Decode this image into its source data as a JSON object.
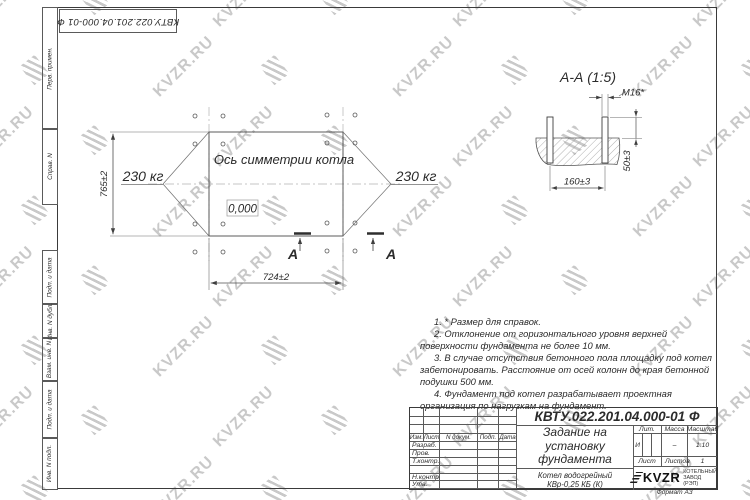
{
  "colors": {
    "line": "#3a3a3a",
    "thin": "#5a5a5a",
    "ink": "#2b2b2b",
    "wm": "#c9c9c9"
  },
  "watermark": {
    "text": "KVZR.RU"
  },
  "document": {
    "number": "КВТУ.022.201.04.000-01 Ф",
    "format_label": "Формат А3"
  },
  "side_strip": {
    "labels": [
      "Перв. примен.",
      "Справ. N",
      "Подп. и дата",
      "Инв. N дубл.",
      "Взам. инв. N",
      "Подп. и дата",
      "Инв. N подл."
    ]
  },
  "plan": {
    "axis_label": "Ось симметрии котла",
    "load_left": "230 кг",
    "load_right": "230 кг",
    "elevation": "0,000",
    "dim_height": "765±2",
    "dim_width": "724±2",
    "section_letter_left": "А",
    "section_letter_right": "А"
  },
  "detail": {
    "title": "А-А (1:5)",
    "bolt_label": "M16*",
    "dim_protrusion": "50±3",
    "dim_spacing": "160±3"
  },
  "notes": [
    "1. * Размер для справок.",
    "2. Отклонение от горизонтального уровня верхней поверхности фундамента не более 10 мм.",
    "3. В случае отсутствия бетонного пола площадку под котел забетонировать. Расстояние от осей колонн до края бетонной подушки 500 мм.",
    "4. Фундамент под котел разрабатывает проектная организация по нагрузкам на фундамент."
  ],
  "title_block": {
    "header_cols": {
      "izm": "Изм.",
      "list": "Лист",
      "n_doc": "N докум.",
      "podp": "Подп.",
      "data": "Дата"
    },
    "rows": [
      "Разраб.",
      "Пров.",
      "Т.контр.",
      "",
      "Н.контр.",
      "Утв."
    ],
    "title_lines": [
      "Задание на",
      "установку",
      "фундамента"
    ],
    "product_lines": [
      "Котел водогрейный",
      "КВр-0,25 КБ (К)"
    ],
    "lit_header": "Лит.",
    "mass_header": "Масса",
    "scale_header": "Масштаб",
    "lit_value": "И",
    "mass_value": "–",
    "scale_value": "1:10",
    "sheet_label": "Лист",
    "sheets_label": "Листов",
    "sheets_value": "1",
    "logo_text": "KVZR",
    "company_lines": [
      "КОТЕЛЬНЫЙ",
      "ЗАВОД (РЭП)"
    ]
  }
}
